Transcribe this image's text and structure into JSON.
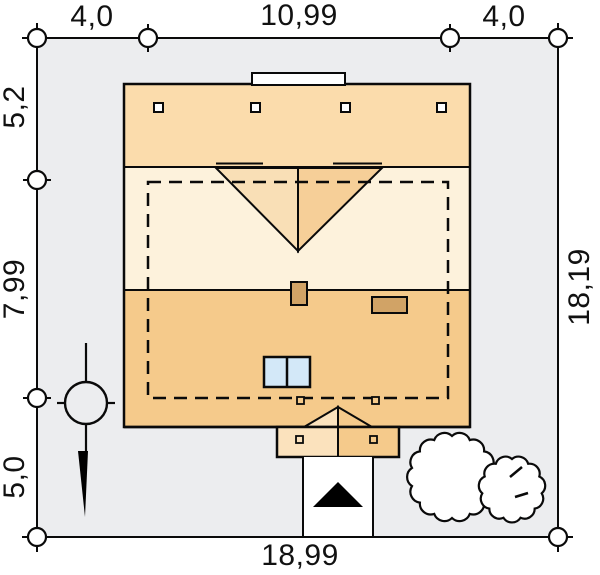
{
  "drawing": {
    "type": "architectural site plan",
    "plot": {
      "width_label": "18,99",
      "depth_label": "18,19"
    },
    "dimensions": {
      "top": [
        "4,0",
        "10,99",
        "4,0"
      ],
      "left": [
        "5,2",
        "7,99",
        "5,0"
      ],
      "right": [
        "18,19"
      ],
      "bottom": [
        "18,99"
      ]
    }
  },
  "symbols": {
    "north_arrow": "black-triangle-up",
    "tree_large": "scalloped-circle",
    "tree_small": "scalloped-circle",
    "survey_point": "circle-with-crosshair",
    "gate_marker": "black-wedge",
    "dimension_marker": "open-circle-with-tick"
  },
  "colors": {
    "page_bg": "#FFFFFF",
    "plot_bg": "#ECEDEF",
    "band_top": "#FBDCAC",
    "band_mid": "#FDF2DC",
    "band_bottom": "#F5CA8B",
    "tri_left": "#F9DFB6",
    "tri_right": "#F6CF98",
    "porch_left": "#FBE2BD",
    "chimney": "#D1A366",
    "skylight": "#D3E8F8",
    "line": "#0A0A0A"
  }
}
